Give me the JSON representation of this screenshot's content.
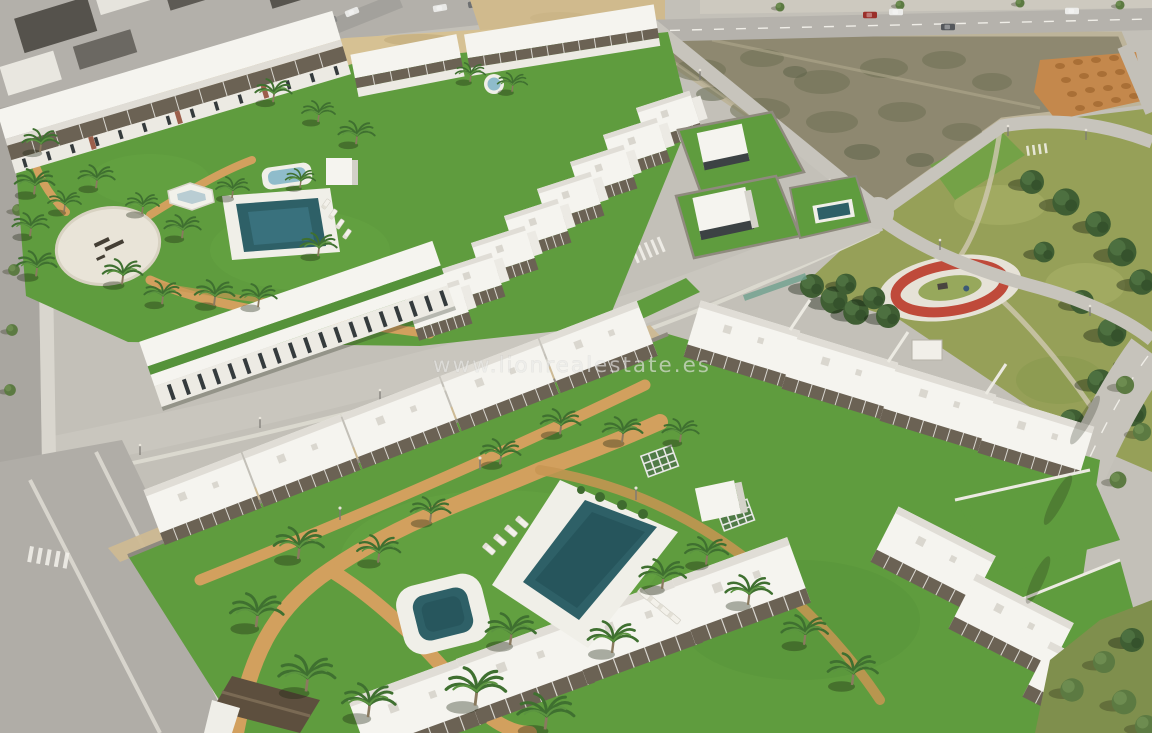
{
  "watermark": {
    "text": "www.lionrealestate.es"
  },
  "colors": {
    "turf": "#5f9c3e",
    "turf_dark": "#55923a",
    "park_grass": "#96a058",
    "sand_path": "#d2a05e",
    "sand_strip": "#d6c193",
    "pool_water": "#2e6067",
    "pool_water_light": "#8fbccb",
    "deck_white": "#f0efe8",
    "building_white": "#f5f4ef",
    "pergola_brown": "#6b6254",
    "road_concrete": "#c9c6be",
    "asphalt": "#aaa7a1",
    "vacant_lot": "#8e8870",
    "excavated_soil": "#c4884c",
    "playground_red": "#bf4a3a",
    "pine_green": "#3f5e33",
    "palm_green": "#3f7030",
    "watermark_gray": "#e9e9e7"
  }
}
